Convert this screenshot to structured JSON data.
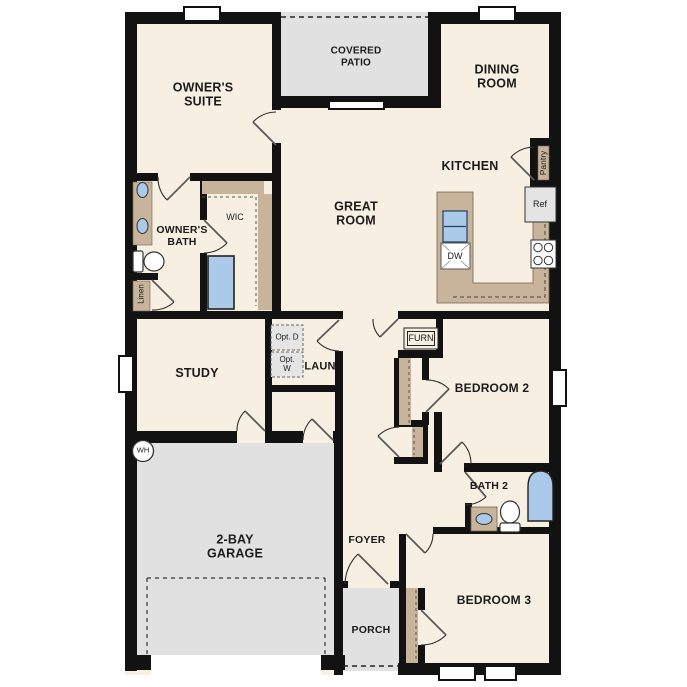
{
  "palette": {
    "wall": "#121212",
    "floor": "#f6efe2",
    "gray": "#e0e1e0",
    "tan": "#c7b49a",
    "blue": "#abcaea",
    "ink": "#1b1b1b"
  },
  "rooms": {
    "owners_suite": "OWNER'S SUITE",
    "covered_patio": "COVERED PATIO",
    "dining_room": "DINING ROOM",
    "kitchen": "KITCHEN",
    "great_room": "GREAT ROOM",
    "owners_bath": "OWNER'S BATH",
    "wic": "WIC",
    "study": "STUDY",
    "laundry": "LAUN",
    "bedroom_2": "BEDROOM 2",
    "bath_2": "BATH 2",
    "bedroom_3": "BEDROOM 3",
    "garage": "2-BAY GARAGE",
    "foyer": "FOYER",
    "porch": "PORCH"
  },
  "features": {
    "pantry": "Pantry",
    "refrigerator": "Ref",
    "dishwasher": "DW",
    "linen": "Linen",
    "furnace": "FURN",
    "water_heater": "WH",
    "optional_dryer": "Opt. D",
    "optional_washer": "Opt. W"
  }
}
